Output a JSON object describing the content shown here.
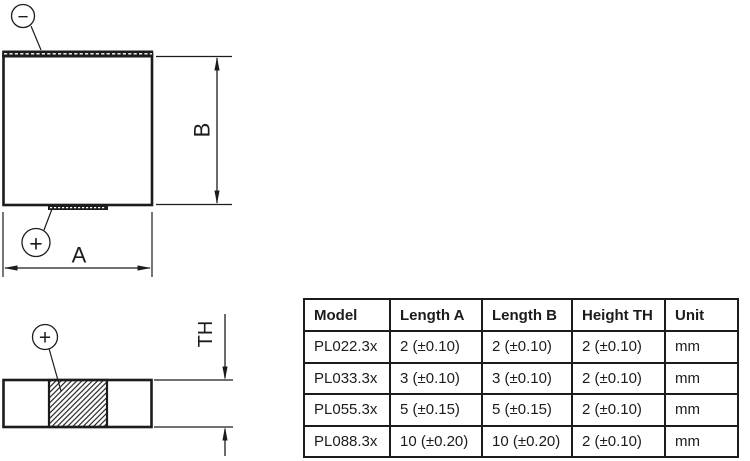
{
  "drawing": {
    "colors": {
      "line": "#1c1c1c",
      "background": "#ffffff"
    },
    "front_view": {
      "label_a": "A",
      "label_b": "B",
      "minus_symbol": "−",
      "plus_symbol": "+"
    },
    "side_view": {
      "label_th": "TH",
      "plus_symbol": "+"
    }
  },
  "table": {
    "headers": [
      "Model",
      "Length A",
      "Length B",
      "Height TH",
      "Unit"
    ],
    "rows": [
      [
        "PL022.3x",
        "2 (±0.10)",
        "2 (±0.10)",
        "2 (±0.10)",
        "mm"
      ],
      [
        "PL033.3x",
        "3 (±0.10)",
        "3 (±0.10)",
        "2 (±0.10)",
        "mm"
      ],
      [
        "PL055.3x",
        "5 (±0.15)",
        "5 (±0.15)",
        "2 (±0.10)",
        "mm"
      ],
      [
        "PL088.3x",
        "10 (±0.20)",
        "10 (±0.20)",
        "2 (±0.10)",
        "mm"
      ]
    ]
  }
}
